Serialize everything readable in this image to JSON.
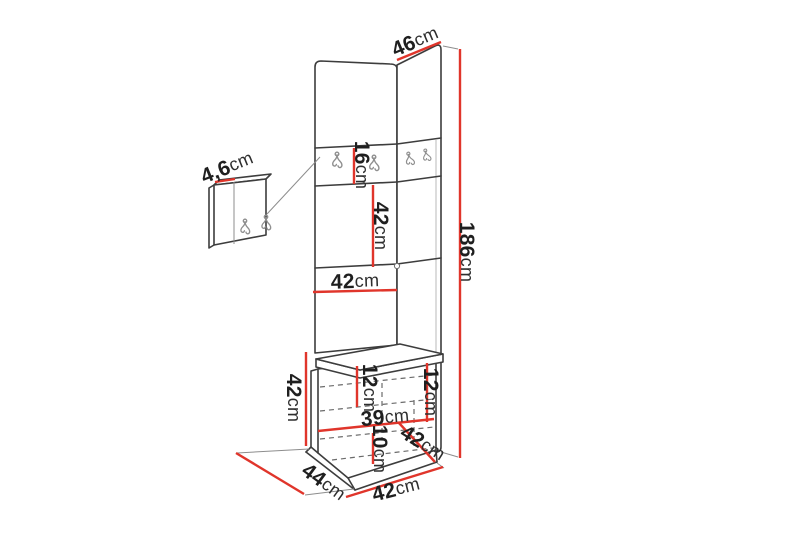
{
  "palette": {
    "background": "#ffffff",
    "line": "#3d3d3d",
    "accent_red": "#e0352b",
    "label_text": "#1f1f1f",
    "hook_gray": "#8f8f8f"
  },
  "diagram": {
    "type": "furniture-dimension-diagram",
    "subject": "Corner hallway unit with upholstered hook panels, wall hook panel and bench shoe cabinet",
    "unit_of_measure": "cm",
    "dimensions": [
      {
        "name": "top-width",
        "value": "46",
        "unit": "cm"
      },
      {
        "name": "total-height",
        "value": "186",
        "unit": "cm"
      },
      {
        "name": "hook-strip-height",
        "value": "16",
        "unit": "cm"
      },
      {
        "name": "upper-section-height",
        "value": "42",
        "unit": "cm"
      },
      {
        "name": "panel-width",
        "value": "42",
        "unit": "cm"
      },
      {
        "name": "hook-panel-thickness",
        "value": "4,6",
        "unit": "cm"
      },
      {
        "name": "bench-height",
        "value": "42",
        "unit": "cm"
      },
      {
        "name": "bench-inner-left-height",
        "value": "12",
        "unit": "cm"
      },
      {
        "name": "bench-inner-right-height",
        "value": "12",
        "unit": "cm"
      },
      {
        "name": "bench-inner-width",
        "value": "39",
        "unit": "cm"
      },
      {
        "name": "bench-inner-bottom-height",
        "value": "10",
        "unit": "cm"
      },
      {
        "name": "bench-side-depth",
        "value": "42",
        "unit": "cm"
      },
      {
        "name": "bench-depth",
        "value": "44",
        "unit": "cm"
      },
      {
        "name": "bench-width",
        "value": "42",
        "unit": "cm"
      }
    ]
  }
}
